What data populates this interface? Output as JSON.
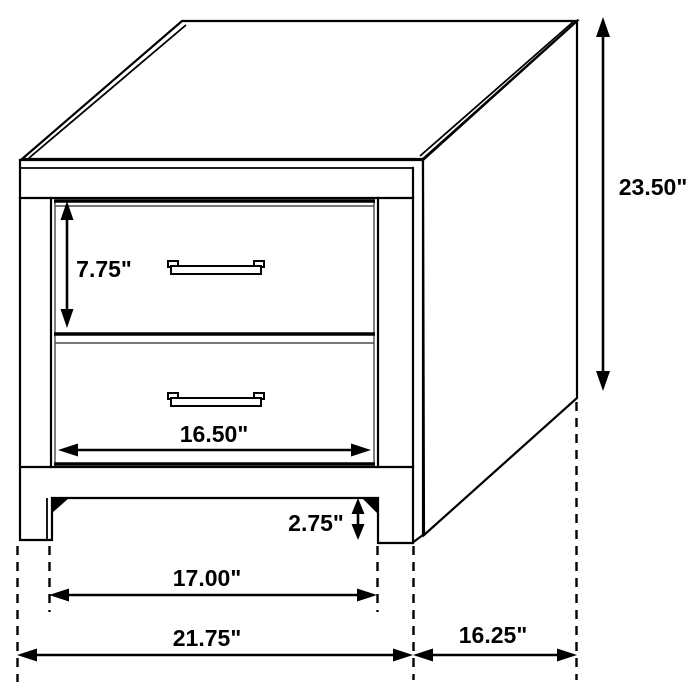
{
  "diagram": {
    "subject": "2-drawer nightstand",
    "style": "black line isometric dimension drawing",
    "unit": "inches",
    "line_color": "#000000",
    "background_color": "#ffffff"
  },
  "dimensions": {
    "overall_height": {
      "label": "23.50\"",
      "inches": 23.5
    },
    "top_drawer_height": {
      "label": "7.75\"",
      "inches": 7.75
    },
    "drawer_front_width": {
      "label": "16.50\"",
      "inches": 16.5
    },
    "base_height": {
      "label": "2.75\"",
      "inches": 2.75
    },
    "between_legs_width": {
      "label": "17.00\"",
      "inches": 17.0
    },
    "overall_width": {
      "label": "21.75\"",
      "inches": 21.75
    },
    "depth": {
      "label": "16.25\"",
      "inches": 16.25
    }
  }
}
